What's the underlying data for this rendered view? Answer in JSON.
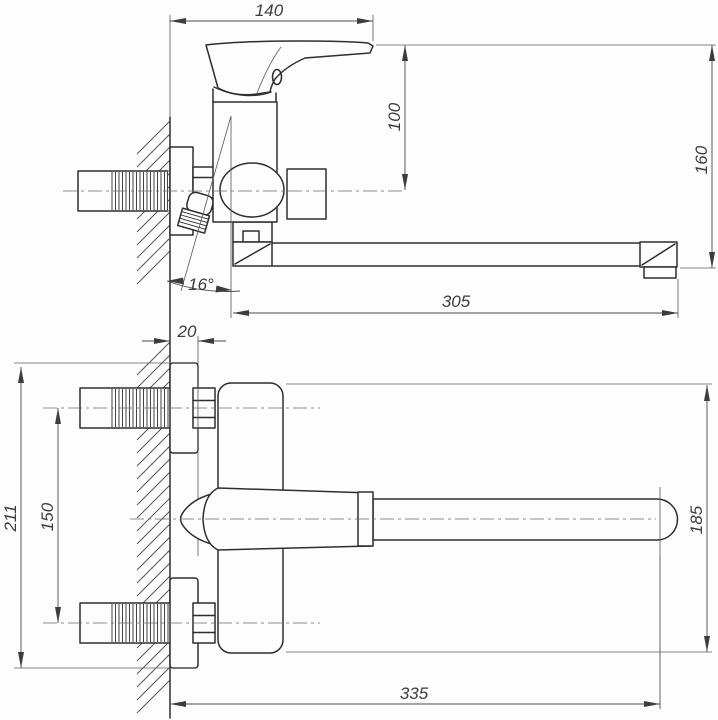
{
  "drawing": {
    "type": "faucet-installation-dimension-drawing",
    "views": {
      "side_view": {
        "dims": {
          "lever_length": "140",
          "drop_to_axis": "100",
          "overall_height": "160",
          "spout_length": "305",
          "eccentric_angle": "16°",
          "wall_offset": "20"
        }
      },
      "plan_view": {
        "dims": {
          "overall_flange_span": "211",
          "inlet_centers": "150",
          "body_span": "185",
          "outlet_reach": "335"
        }
      }
    }
  }
}
